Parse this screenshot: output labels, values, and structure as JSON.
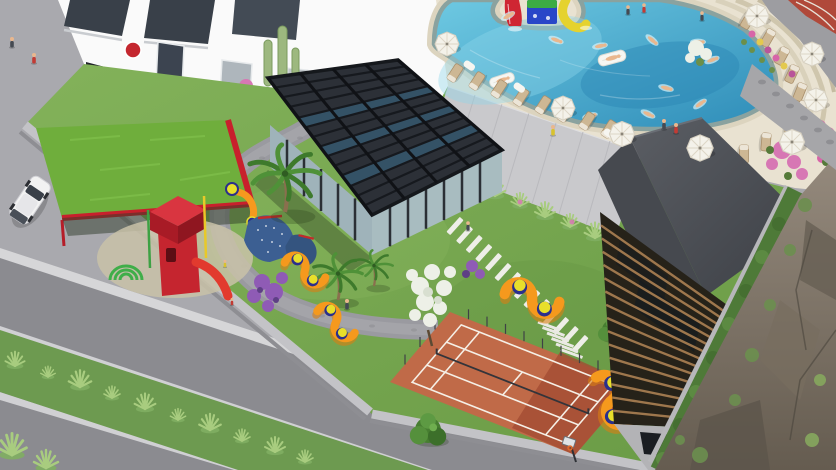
{
  "meta": {
    "type": "3d-architectural-aerial-render",
    "subject": "residential complex amenity courtyard",
    "visible_text": "none"
  },
  "scene": {
    "street": "paved street with planted median, parked white car and scooter",
    "building_left": "white residential block with dark glazing, shop posters and entrance",
    "pool_area": "free-form swimming pool on raised deck with slides, swimmers, floats, umbrellas and sun loungers",
    "garden": "walled courtyard garden with playground canopy, glass pergola hall, palm trees, paths and stepping stones",
    "tennis_court": "terracotta tennis court with white lines, net and basketball hoop",
    "timber_building": "tall building with wooden louver facade and slate roof",
    "cliff": "rocky slope with moss and flowering shrubs on the right"
  },
  "objects": {
    "umbrellas": 8,
    "sun_loungers": 17,
    "swimmers": 10,
    "pool_floats": 2,
    "water_slides": 3,
    "s_benches": 4,
    "palm_trees": 3,
    "leafy_trees": 5,
    "people_standing": 13,
    "cars": 1,
    "scooters": 1
  },
  "palette": {
    "pavement": "#a9a9ae",
    "road": "#8b8b90",
    "curb": "#d6d6d8",
    "median_grass": "#6d9a50",
    "plant_light": "#a8cc7f",
    "building_white": "#fafafa",
    "glazing_dark": "#394049",
    "sign_red": "#c4272f",
    "wall_gray": "#c9c9cc",
    "deck_cream": "#e9e2d1",
    "coping_stone": "#8aa29f",
    "pool_light": "#6ec9e2",
    "pool_deep": "#2e8cb8",
    "water_splash": "#cfeef5",
    "skin": "#e9b78e",
    "slide_red": "#cf2633",
    "slide_blue": "#2946c8",
    "slide_green": "#3cab44",
    "slide_yellow": "#e5d22e",
    "umbrella_white": "#f4f2ea",
    "lounger_beige": "#cdb794",
    "grass_light": "#83b25a",
    "grass_dark": "#699a45",
    "grass_roof": "#6fae3c",
    "canopy_red": "#c8202c",
    "play_red": "#c5252f",
    "climber_blue": "#3c5f92",
    "bench_orange": "#f5991d",
    "stool_blue": "#2b2f8c",
    "stool_yellow": "#e8df2b",
    "pergola_dark": "#2c3037",
    "glass_teal": "#9fb3ba",
    "glass_glint": "#3e7da0",
    "path_gray": "#9a9aa0",
    "plank_white": "#eeeee8",
    "tennis_base": "#c06a48",
    "tennis_dark": "#a34c33",
    "line_white": "#f5efe6",
    "roof_slate_light": "#5b5e64",
    "roof_slate_dark": "#3c3f45",
    "timber_wood": "#a57c50",
    "timber_dark": "#262219",
    "hedge_green": "#4e7a38",
    "rock_light": "#958a7d",
    "rock_dark": "#655c50",
    "moss_green": "#6c8f4f",
    "flower_pink": "#d765a8",
    "flower_purple": "#8f5bb5",
    "flower_white": "#edf0e7",
    "bougainvillea": "#d777b4",
    "track_red": "#b0493a",
    "car_white": "#f2f2f2"
  }
}
